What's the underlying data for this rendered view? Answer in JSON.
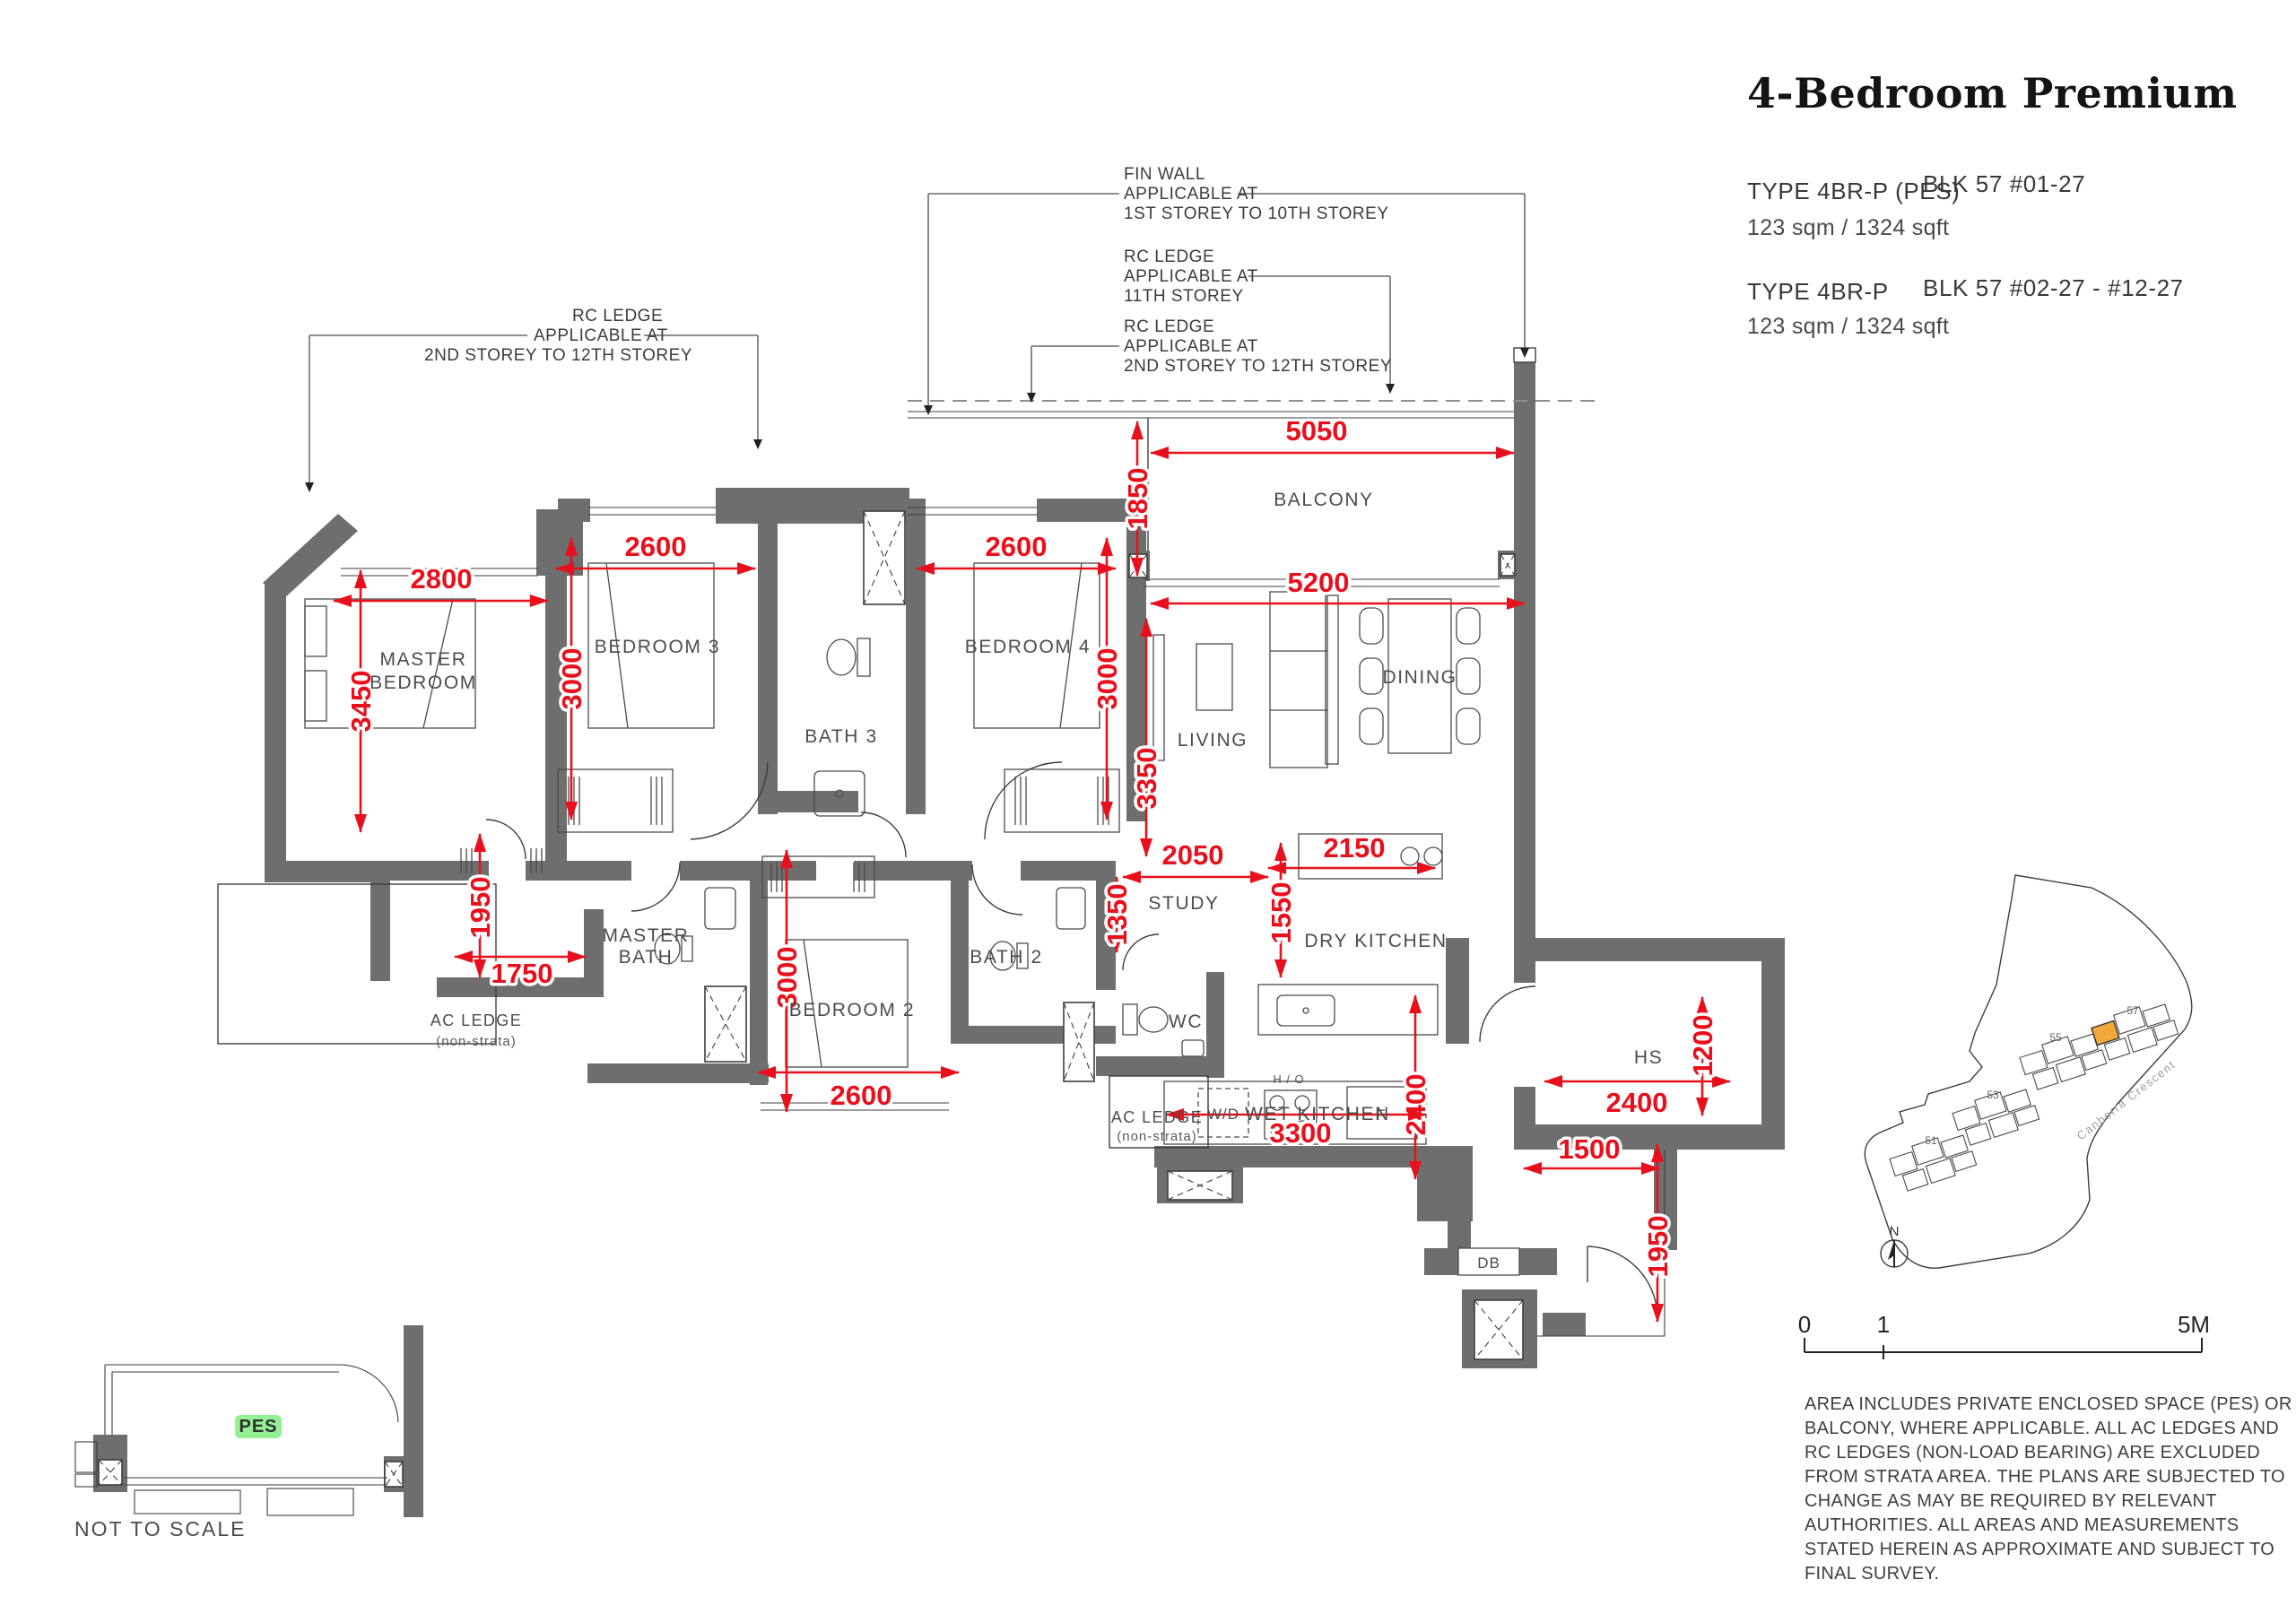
{
  "title": "4-Bedroom Premium",
  "types": [
    {
      "type": "TYPE 4BR-P (PES)",
      "blk": "BLK 57 #01-27",
      "area": "123 sqm / 1324 sqft"
    },
    {
      "type": "TYPE 4BR-P",
      "blk": "BLK 57  #02-27  - #12-27",
      "area": "123 sqm / 1324 sqft"
    }
  ],
  "annotations": {
    "fin_wall": {
      "l1": "FIN WALL",
      "l2": "APPLICABLE AT",
      "l3": "1ST STOREY TO 10TH  STOREY"
    },
    "rc_ledge_11": {
      "l1": "RC LEDGE",
      "l2": "APPLICABLE AT",
      "l3": "11TH STOREY"
    },
    "rc_ledge_right": {
      "l1": "RC LEDGE",
      "l2": "APPLICABLE AT",
      "l3": "2ND STOREY TO 12TH  STOREY"
    },
    "rc_ledge_left": {
      "l1": "RC LEDGE",
      "l2": "APPLICABLE AT",
      "l3": "2ND STOREY TO 12TH  STOREY"
    }
  },
  "rooms": {
    "master_bedroom_1": "MASTER",
    "master_bedroom_2": "BEDROOM",
    "bedroom3": "BEDROOM 3",
    "bath3": "BATH 3",
    "bedroom4": "BEDROOM 4",
    "balcony": "BALCONY",
    "living": "LIVING",
    "dining": "DINING",
    "study": "STUDY",
    "dry_kitchen": "DRY KITCHEN",
    "wet_kitchen": "WET KITCHEN",
    "master_bath_1": "MASTER",
    "master_bath_2": "BATH",
    "bedroom2": "BEDROOM 2",
    "bath2": "BATH 2",
    "wc": "WC",
    "hs": "HS",
    "db": "DB",
    "wd": "W/D",
    "ho": "H / O",
    "fridge": "F"
  },
  "ac_ledge": {
    "l1": "AC LEDGE",
    "l2": "(non-strata)"
  },
  "dims": {
    "mb_w": "2800",
    "mb_h": "3450",
    "br3_w": "2600",
    "br3_h": "3000",
    "br4_w": "2600",
    "br4_h": "3000",
    "balc_w": "5050",
    "balc_h": "1850",
    "liv_w": "5200",
    "liv_h": "3350",
    "closet_h": "1950",
    "closet_w": "1750",
    "br2_w": "2600",
    "br2_h": "3000",
    "study_w": "2050",
    "study_h": "1350",
    "dryk_w": "2150",
    "dryk_h": "1550",
    "wetk_w": "3300",
    "wetk_h": "2400",
    "hs_w": "2400",
    "hs_h": "1200",
    "entry_w": "1500",
    "entry_h": "1950"
  },
  "pes_inset": {
    "label": "PES",
    "caption": "NOT TO SCALE"
  },
  "scale_bar": {
    "t0": "0",
    "t1": "1",
    "t2": "5M"
  },
  "site_plan": {
    "b51": "51",
    "b53": "53",
    "b55": "55",
    "b57": "57",
    "road": "Canberra Crescent",
    "north": "N"
  },
  "disclaimer": [
    "AREA INCLUDES PRIVATE ENCLOSED SPACE (PES) OR",
    "BALCONY, WHERE APPLICABLE. ALL AC LEDGES AND",
    "RC LEDGES (NON-LOAD BEARING) ARE EXCLUDED",
    "FROM STRATA AREA. THE PLANS ARE SUBJECTED TO",
    "CHANGE AS MAY BE REQUIRED BY RELEVANT",
    "AUTHORITIES. ALL AREAS AND MEASUREMENTS",
    "STATED HEREIN AS APPROXIMATE AND SUBJECT TO",
    "FINAL SURVEY."
  ],
  "colors": {
    "wall": "#6e6e6e",
    "dim_red": "#e8101c",
    "pes_green": "#93f093",
    "unit_orange": "#f2a93b"
  }
}
